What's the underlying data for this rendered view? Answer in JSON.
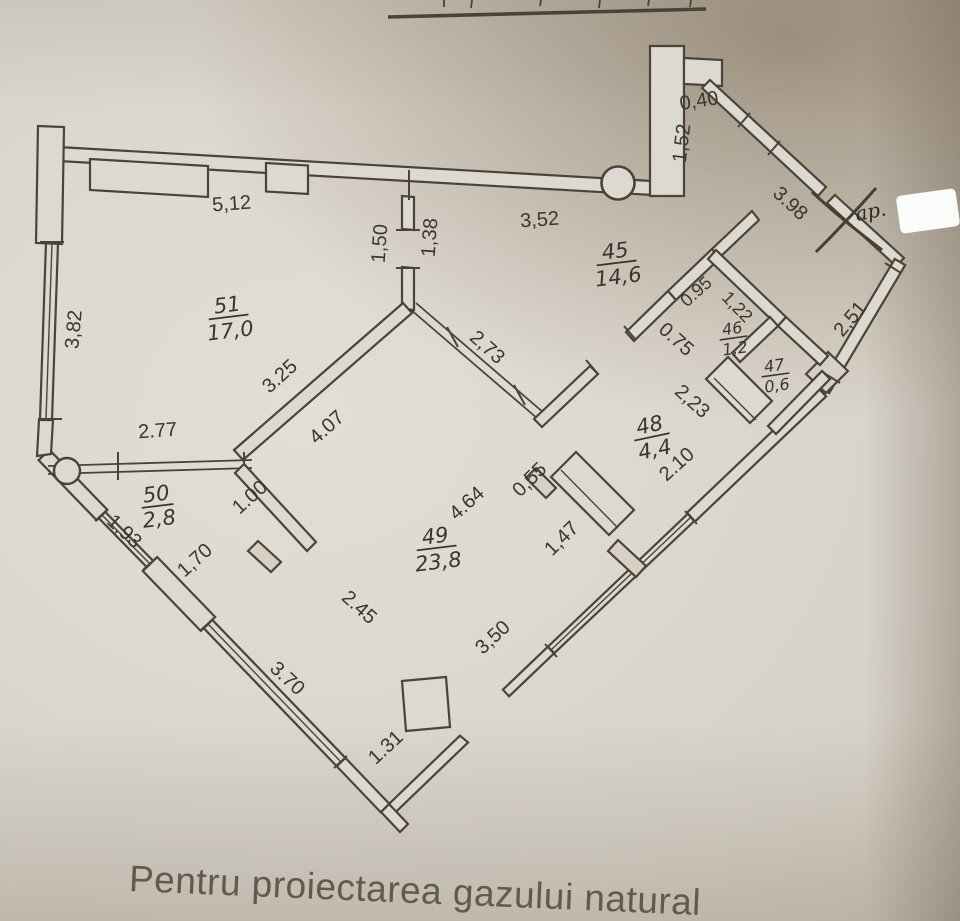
{
  "page": {
    "caption": "Pentru proiectarea gazului natural",
    "annotation": "ap."
  },
  "rooms": {
    "r45": {
      "num": "45",
      "area": "14,6"
    },
    "r46": {
      "num": "46",
      "area": "1,2"
    },
    "r47": {
      "num": "47",
      "area": "0,6"
    },
    "r48": {
      "num": "48",
      "area": "4,4"
    },
    "r49": {
      "num": "49",
      "area": "23,8"
    },
    "r50": {
      "num": "50",
      "area": "2,8"
    },
    "r51": {
      "num": "51",
      "area": "17,0"
    }
  },
  "dims": {
    "d512": "5,12",
    "d352": "3,52",
    "d040": "0,40",
    "d152": "1,52",
    "d398": "3.98",
    "d251": "2,51",
    "d382": "3,82",
    "d150": "1,50",
    "d138": "1,38",
    "d277": "2.77",
    "d325": "3.25",
    "d407": "4.07",
    "d273": "2,73",
    "d095": "0.95",
    "d122": "1,22",
    "d075": "0.75",
    "d223": "2,23",
    "d210": "2.10",
    "d100": "1.00",
    "d170": "1,70",
    "d193": "1,93",
    "d464": "4.64",
    "d055": "0,55",
    "d147": "1,47",
    "d245": "2.45",
    "d350": "3,50",
    "d370": "3.70",
    "d131": "1.31"
  }
}
